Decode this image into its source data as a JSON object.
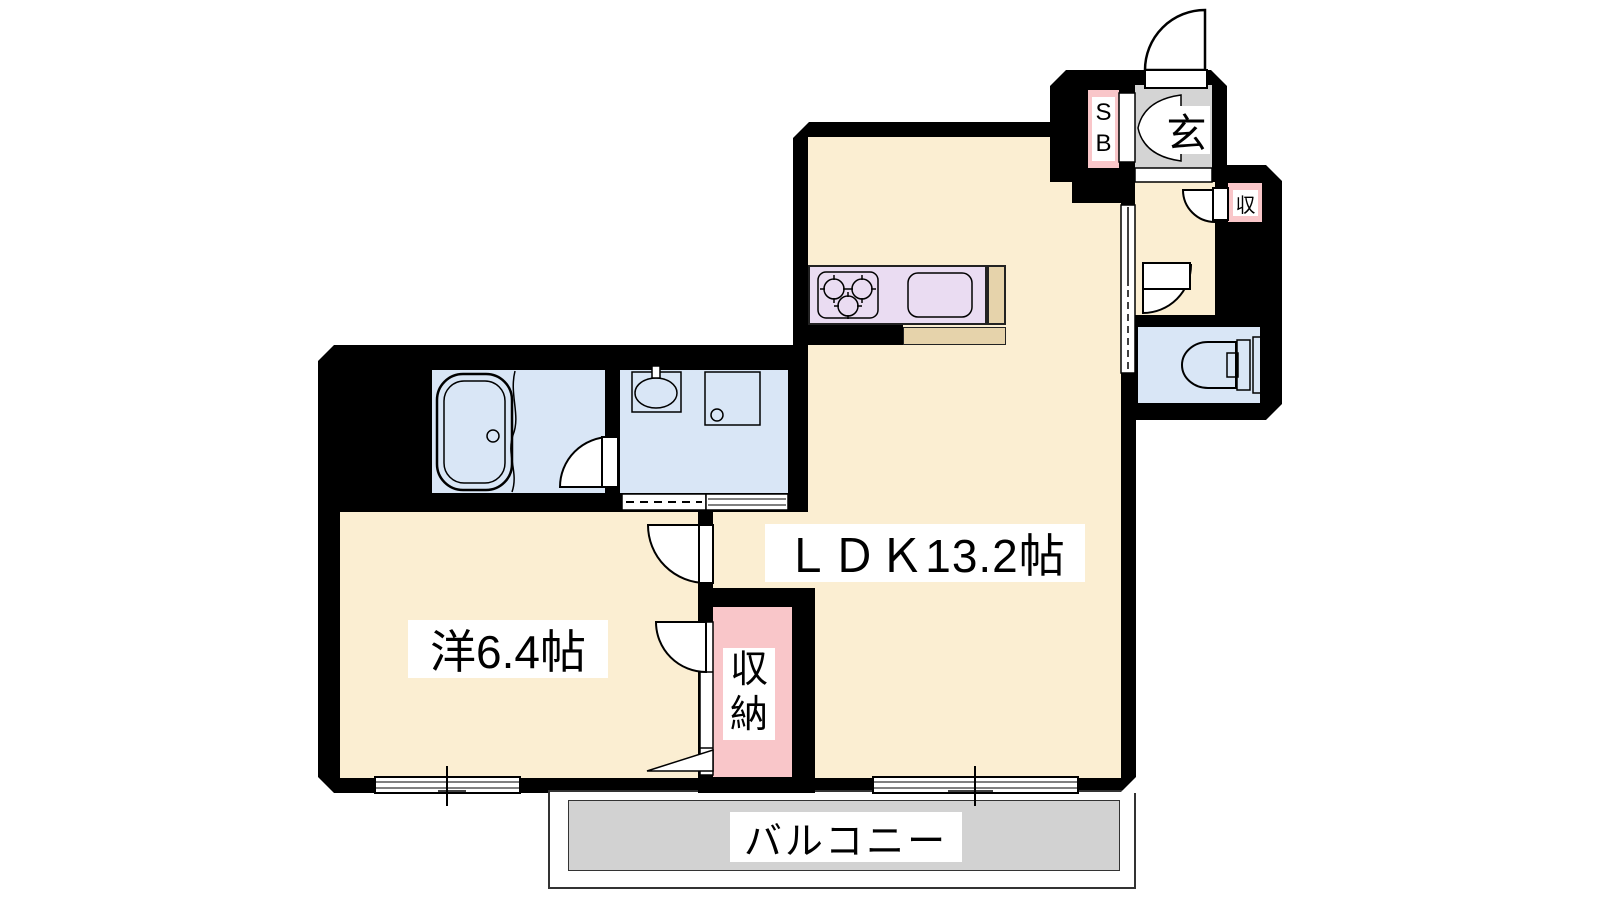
{
  "title": "1LDK apartment floor plan",
  "rooms": {
    "ldk": {
      "label": "ＬＤＫ13.2帖"
    },
    "western": {
      "label": "洋6.4帖"
    },
    "closet": {
      "label": "収納"
    },
    "balcony": {
      "label": "バルコニー"
    },
    "genkan": {
      "label": "玄"
    },
    "shoe_box": {
      "label": "SB"
    },
    "hall_closet": {
      "label": "収"
    }
  },
  "colors": {
    "wall": "#000000",
    "room_floor": "#FBEED2",
    "wet_area_floor": "#D9E6F6",
    "storage_pink": "#F9C6C9",
    "genkan_gray": "#D4D4D4",
    "balcony_gray": "#D2D2D2",
    "kitchen_counter": "#EADCF2",
    "counter_wood": "#E6D3AB"
  },
  "fixtures": [
    "bathtub",
    "washbasin",
    "washing-machine-pan",
    "toilet",
    "gas-stove",
    "kitchen-sink"
  ]
}
